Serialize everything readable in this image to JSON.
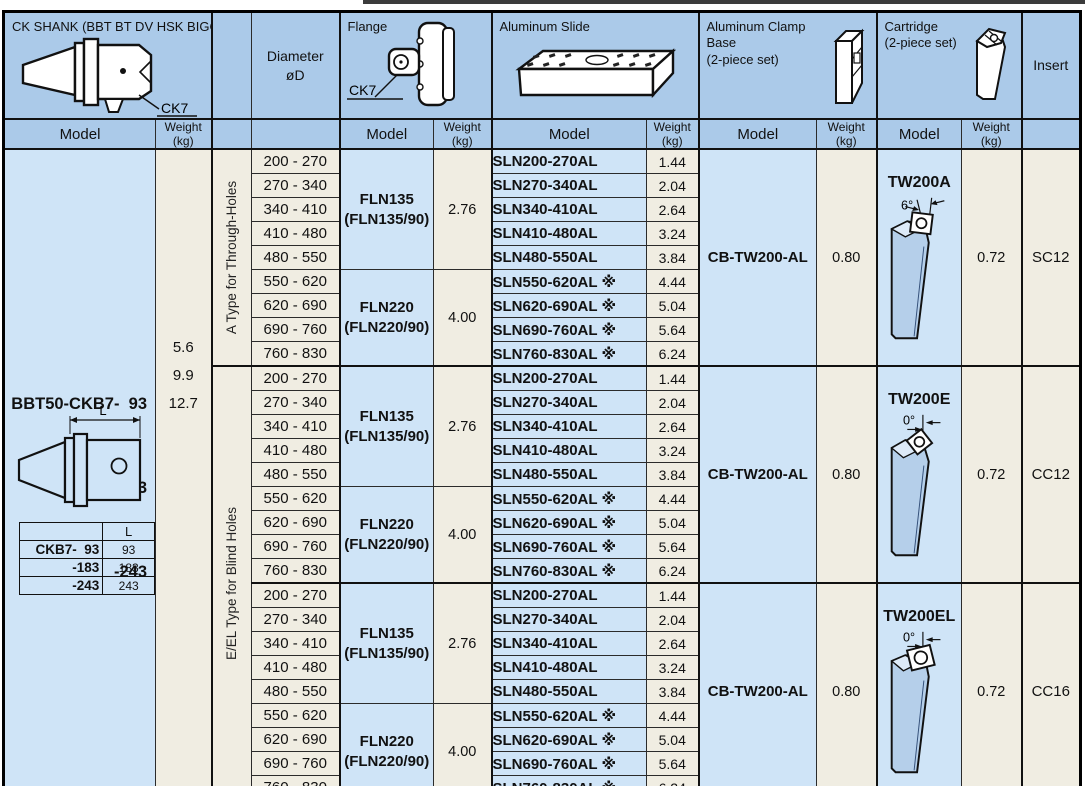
{
  "page": {
    "top_rule_color": "#3b3b3b"
  },
  "colors": {
    "header_blue": "#abcae9",
    "cell_blue": "#cfe4f7",
    "cell_beige": "#f0ede2",
    "drawing_blue": "#b5cfea"
  },
  "columns": {
    "model_header": "Model",
    "weight_header": "Weight (kg)"
  },
  "header": {
    "shank_title": "CK SHANK (BBT BT DV HSK BIGCAPTO)",
    "shank_callout": "CK7",
    "diameter_title_1": "Diameter",
    "diameter_title_2": "øD",
    "flange_title": "Flange",
    "flange_callout": "CK7",
    "slide_title": "Aluminum Slide",
    "clamp_title_1": "Aluminum Clamp",
    "clamp_title_2": "Base",
    "clamp_title_3": "(2-piece set)",
    "cartridge_title_1": "Cartridge",
    "cartridge_title_2": "(2-piece set)",
    "insert_title": "Insert"
  },
  "shank": {
    "models": [
      {
        "name": "BBT50-CKB7-  93",
        "weight": "5.6"
      },
      {
        "name": "-183",
        "weight": "9.9"
      },
      {
        "name": "-243",
        "weight": "12.7"
      }
    ],
    "dim_label": "L",
    "size_table": {
      "header": "L",
      "rows": [
        {
          "model": "CKB7-  93",
          "value": "93"
        },
        {
          "model": "-183",
          "value": "183"
        },
        {
          "model": "-243",
          "value": "243"
        }
      ]
    }
  },
  "type_groups": [
    {
      "label": "A Type for Through-Holes"
    },
    {
      "label": "E/EL Type for Blind Holes"
    }
  ],
  "sections": [
    {
      "flange_groups": [
        {
          "model": "FLN135",
          "alt": "(FLN135/90)",
          "weight": "2.76"
        },
        {
          "model": "FLN220",
          "alt": "(FLN220/90)",
          "weight": "4.00"
        }
      ],
      "rows": [
        {
          "diameter": "200 - 270",
          "slide_model": "SLN200-270AL",
          "slide_weight": "1.44"
        },
        {
          "diameter": "270 - 340",
          "slide_model": "SLN270-340AL",
          "slide_weight": "2.04"
        },
        {
          "diameter": "340 - 410",
          "slide_model": "SLN340-410AL",
          "slide_weight": "2.64"
        },
        {
          "diameter": "410 - 480",
          "slide_model": "SLN410-480AL",
          "slide_weight": "3.24"
        },
        {
          "diameter": "480 - 550",
          "slide_model": "SLN480-550AL",
          "slide_weight": "3.84"
        },
        {
          "diameter": "550 - 620",
          "slide_model": "SLN550-620AL ※",
          "slide_weight": "4.44"
        },
        {
          "diameter": "620 - 690",
          "slide_model": "SLN620-690AL ※",
          "slide_weight": "5.04"
        },
        {
          "diameter": "690 - 760",
          "slide_model": "SLN690-760AL ※",
          "slide_weight": "5.64"
        },
        {
          "diameter": "760 - 830",
          "slide_model": "SLN760-830AL ※",
          "slide_weight": "6.24"
        }
      ],
      "clamp_model": "CB-TW200-AL",
      "clamp_weight": "0.80",
      "cartridge_model": "TW200A",
      "cartridge_angle": "6°",
      "cartridge_weight": "0.72",
      "insert": "SC12"
    },
    {
      "flange_groups": [
        {
          "model": "FLN135",
          "alt": "(FLN135/90)",
          "weight": "2.76"
        },
        {
          "model": "FLN220",
          "alt": "(FLN220/90)",
          "weight": "4.00"
        }
      ],
      "rows": [
        {
          "diameter": "200 - 270",
          "slide_model": "SLN200-270AL",
          "slide_weight": "1.44"
        },
        {
          "diameter": "270 - 340",
          "slide_model": "SLN270-340AL",
          "slide_weight": "2.04"
        },
        {
          "diameter": "340 - 410",
          "slide_model": "SLN340-410AL",
          "slide_weight": "2.64"
        },
        {
          "diameter": "410 - 480",
          "slide_model": "SLN410-480AL",
          "slide_weight": "3.24"
        },
        {
          "diameter": "480 - 550",
          "slide_model": "SLN480-550AL",
          "slide_weight": "3.84"
        },
        {
          "diameter": "550 - 620",
          "slide_model": "SLN550-620AL ※",
          "slide_weight": "4.44"
        },
        {
          "diameter": "620 - 690",
          "slide_model": "SLN620-690AL ※",
          "slide_weight": "5.04"
        },
        {
          "diameter": "690 - 760",
          "slide_model": "SLN690-760AL ※",
          "slide_weight": "5.64"
        },
        {
          "diameter": "760 - 830",
          "slide_model": "SLN760-830AL ※",
          "slide_weight": "6.24"
        }
      ],
      "clamp_model": "CB-TW200-AL",
      "clamp_weight": "0.80",
      "cartridge_model": "TW200E",
      "cartridge_angle": "0°",
      "cartridge_weight": "0.72",
      "insert": "CC12"
    },
    {
      "flange_groups": [
        {
          "model": "FLN135",
          "alt": "(FLN135/90)",
          "weight": "2.76"
        },
        {
          "model": "FLN220",
          "alt": "(FLN220/90)",
          "weight": "4.00"
        }
      ],
      "rows": [
        {
          "diameter": "200 - 270",
          "slide_model": "SLN200-270AL",
          "slide_weight": "1.44"
        },
        {
          "diameter": "270 - 340",
          "slide_model": "SLN270-340AL",
          "slide_weight": "2.04"
        },
        {
          "diameter": "340 - 410",
          "slide_model": "SLN340-410AL",
          "slide_weight": "2.64"
        },
        {
          "diameter": "410 - 480",
          "slide_model": "SLN410-480AL",
          "slide_weight": "3.24"
        },
        {
          "diameter": "480 - 550",
          "slide_model": "SLN480-550AL",
          "slide_weight": "3.84"
        },
        {
          "diameter": "550 - 620",
          "slide_model": "SLN550-620AL ※",
          "slide_weight": "4.44"
        },
        {
          "diameter": "620 - 690",
          "slide_model": "SLN620-690AL ※",
          "slide_weight": "5.04"
        },
        {
          "diameter": "690 - 760",
          "slide_model": "SLN690-760AL ※",
          "slide_weight": "5.64"
        },
        {
          "diameter": "760 - 830",
          "slide_model": "SLN760-830AL ※",
          "slide_weight": "6.24"
        }
      ],
      "clamp_model": "CB-TW200-AL",
      "clamp_weight": "0.80",
      "cartridge_model": "TW200EL",
      "cartridge_angle": "0°",
      "cartridge_weight": "0.72",
      "insert": "CC16"
    }
  ]
}
